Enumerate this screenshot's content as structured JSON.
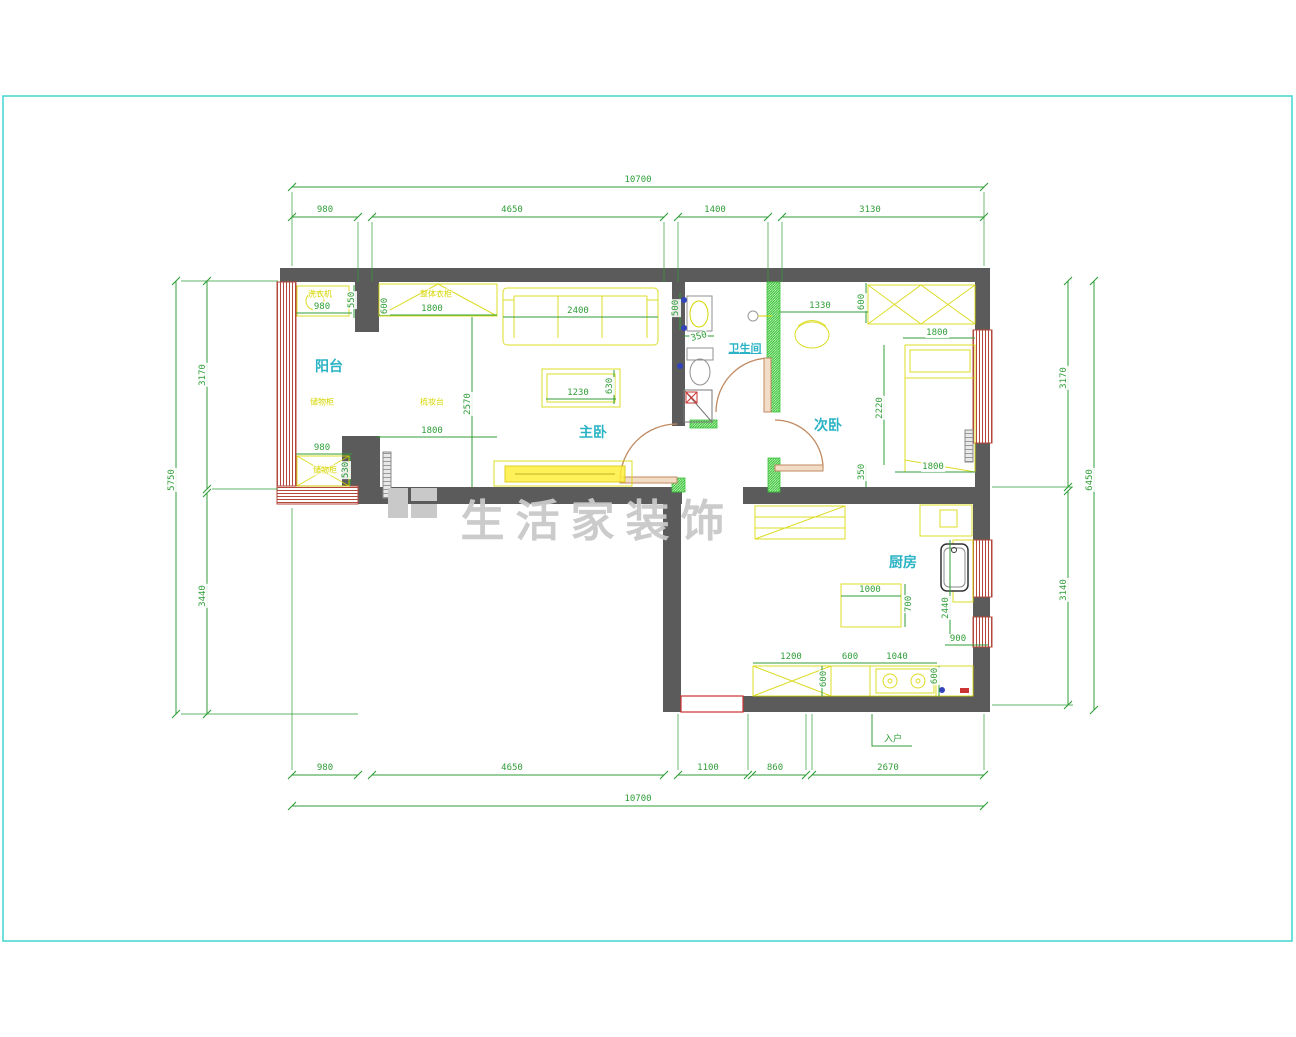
{
  "colors": {
    "wall": "#5b5b5b",
    "dim": "#2f9e38",
    "room": "#2ab3c4",
    "furn": "#d6d600",
    "win": "#b5483c",
    "door": "#c08a62",
    "doorfill": "#f2dcc6",
    "newwall": "#3cc43c",
    "watermark": "#c9c9c9",
    "frame": "#41d6d0",
    "red": "#cc3333",
    "blue": "#3344bb",
    "fix": "#909090"
  },
  "watermark_text": "生活家装饰",
  "rooms": [
    "阳台",
    "主卧",
    "卫生间",
    "次卧",
    "厨房"
  ],
  "overall_dimensions": {
    "top_total": "10700",
    "bottom_total": "10700",
    "left_total": "5750",
    "right_total": "6450"
  },
  "annotations": [
    {
      "t": "10700",
      "x": 638,
      "y": 180,
      "c": "d"
    },
    {
      "t": "980",
      "x": 325,
      "y": 210,
      "c": "d"
    },
    {
      "t": "4650",
      "x": 512,
      "y": 210,
      "c": "d"
    },
    {
      "t": "1400",
      "x": 715,
      "y": 210,
      "c": "d"
    },
    {
      "t": "3130",
      "x": 870,
      "y": 210,
      "c": "d"
    },
    {
      "t": "980",
      "x": 325,
      "y": 768,
      "c": "d"
    },
    {
      "t": "4650",
      "x": 512,
      "y": 768,
      "c": "d"
    },
    {
      "t": "1100",
      "x": 708,
      "y": 768,
      "c": "d"
    },
    {
      "t": "860",
      "x": 775,
      "y": 768,
      "c": "d"
    },
    {
      "t": "2670",
      "x": 888,
      "y": 768,
      "c": "d"
    },
    {
      "t": "10700",
      "x": 638,
      "y": 799,
      "c": "d"
    },
    {
      "t": "入户",
      "x": 893,
      "y": 738,
      "c": "d"
    },
    {
      "t": "5750",
      "x": 172,
      "y": 480,
      "r": -90,
      "c": "d"
    },
    {
      "t": "3170",
      "x": 203,
      "y": 375,
      "r": -90,
      "c": "d"
    },
    {
      "t": "3440",
      "x": 203,
      "y": 596,
      "r": -90,
      "c": "d"
    },
    {
      "t": "3170",
      "x": 1064,
      "y": 378,
      "r": -90,
      "c": "d"
    },
    {
      "t": "3140",
      "x": 1064,
      "y": 590,
      "r": -90,
      "c": "d"
    },
    {
      "t": "6450",
      "x": 1090,
      "y": 480,
      "r": -90,
      "c": "d"
    },
    {
      "t": "980",
      "x": 322,
      "y": 307,
      "c": "d"
    },
    {
      "t": "550",
      "x": 352,
      "y": 300,
      "r": -90,
      "c": "d"
    },
    {
      "t": "600",
      "x": 385,
      "y": 306,
      "r": -90,
      "c": "d"
    },
    {
      "t": "1800",
      "x": 432,
      "y": 309,
      "c": "d"
    },
    {
      "t": "2400",
      "x": 578,
      "y": 311,
      "c": "d"
    },
    {
      "t": "1230",
      "x": 578,
      "y": 393,
      "c": "d"
    },
    {
      "t": "630",
      "x": 610,
      "y": 386,
      "r": -90,
      "c": "d"
    },
    {
      "t": "2570",
      "x": 468,
      "y": 404,
      "r": -90,
      "c": "d"
    },
    {
      "t": "1800",
      "x": 432,
      "y": 431,
      "c": "d"
    },
    {
      "t": "980",
      "x": 322,
      "y": 448,
      "c": "d"
    },
    {
      "t": "530",
      "x": 346,
      "y": 470,
      "r": -90,
      "c": "d"
    },
    {
      "t": "500",
      "x": 676,
      "y": 308,
      "r": -90,
      "c": "d"
    },
    {
      "t": "350",
      "x": 699,
      "y": 337,
      "r": -15,
      "c": "d"
    },
    {
      "t": "1330",
      "x": 820,
      "y": 306,
      "c": "d"
    },
    {
      "t": "600",
      "x": 862,
      "y": 302,
      "r": -90,
      "c": "d"
    },
    {
      "t": "1800",
      "x": 937,
      "y": 333,
      "c": "d"
    },
    {
      "t": "2220",
      "x": 880,
      "y": 408,
      "r": -90,
      "c": "d"
    },
    {
      "t": "350",
      "x": 862,
      "y": 472,
      "r": -90,
      "c": "d"
    },
    {
      "t": "1800",
      "x": 933,
      "y": 467,
      "c": "d"
    },
    {
      "t": "1000",
      "x": 870,
      "y": 590,
      "c": "d"
    },
    {
      "t": "700",
      "x": 909,
      "y": 604,
      "r": -90,
      "c": "d"
    },
    {
      "t": "2440",
      "x": 946,
      "y": 608,
      "r": -90,
      "c": "d"
    },
    {
      "t": "900",
      "x": 958,
      "y": 639,
      "c": "d"
    },
    {
      "t": "1200",
      "x": 791,
      "y": 657,
      "c": "d"
    },
    {
      "t": "600",
      "x": 850,
      "y": 657,
      "c": "d"
    },
    {
      "t": "1040",
      "x": 897,
      "y": 657,
      "c": "d"
    },
    {
      "t": "600",
      "x": 824,
      "y": 679,
      "r": -90,
      "c": "d"
    },
    {
      "t": "600",
      "x": 935,
      "y": 676,
      "r": -90,
      "c": "d"
    },
    {
      "t": "阳台",
      "x": 329,
      "y": 366,
      "c": "room"
    },
    {
      "t": "主卧",
      "x": 593,
      "y": 432,
      "c": "room"
    },
    {
      "t": "卫生间",
      "x": 745,
      "y": 348,
      "c": "room-sm"
    },
    {
      "t": "次卧",
      "x": 828,
      "y": 425,
      "c": "room"
    },
    {
      "t": "厨房",
      "x": 903,
      "y": 562,
      "c": "room"
    },
    {
      "t": "洗衣机",
      "x": 320,
      "y": 294,
      "c": "furn"
    },
    {
      "t": "整体衣柜",
      "x": 436,
      "y": 294,
      "c": "furn"
    },
    {
      "t": "储物柜",
      "x": 322,
      "y": 402,
      "c": "furn"
    },
    {
      "t": "梳妆台",
      "x": 432,
      "y": 402,
      "c": "furn"
    },
    {
      "t": "储物柜",
      "x": 325,
      "y": 470,
      "c": "furn"
    },
    {
      "t": "生活家装饰",
      "x": 598,
      "y": 517,
      "c": "wm"
    }
  ]
}
